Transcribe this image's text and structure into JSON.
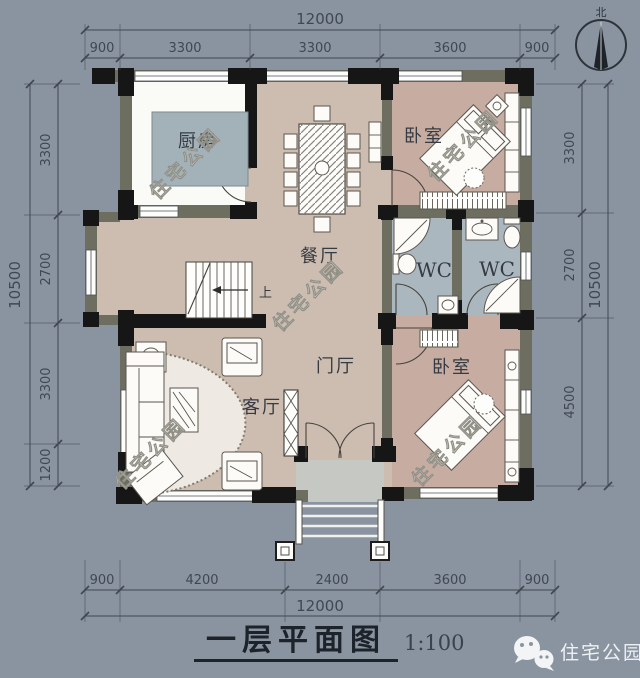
{
  "watermark": {
    "text": "住宅公园"
  },
  "compass": {
    "north_label": "北"
  },
  "rooms": {
    "kitchen": "厨房",
    "dining": "餐厅",
    "bedroom_top": "卧室",
    "bedroom_bottom": "卧室",
    "wc_left": "WC",
    "wc_right": "WC",
    "foyer": "门厅",
    "living": "客厅",
    "stairs_up_label": "上"
  },
  "dimensions": {
    "top": {
      "overall": "12000",
      "segments": [
        "900",
        "3300",
        "3300",
        "3600",
        "900"
      ]
    },
    "bottom": {
      "overall": "12000",
      "segments": [
        "900",
        "4200",
        "2400",
        "3600",
        "900"
      ]
    },
    "left": {
      "overall": "10500",
      "segments": [
        "3300",
        "2700",
        "3300",
        "1200"
      ]
    },
    "right": {
      "overall": "10500",
      "segments": [
        "3300",
        "2700",
        "4500"
      ]
    }
  },
  "title_block": {
    "title": "一层平面图",
    "scale": "1:100"
  },
  "brand": {
    "name": "住宅公园"
  },
  "colors": {
    "background": "#8a94a1",
    "floor_main": "#cdbdb1",
    "floor_bedroom": "#c7aca2",
    "floor_wc": "#abb7bf",
    "floor_kitchen": "#fafaf6",
    "island": "#a3b1b9",
    "wall": "#6e6e60"
  }
}
